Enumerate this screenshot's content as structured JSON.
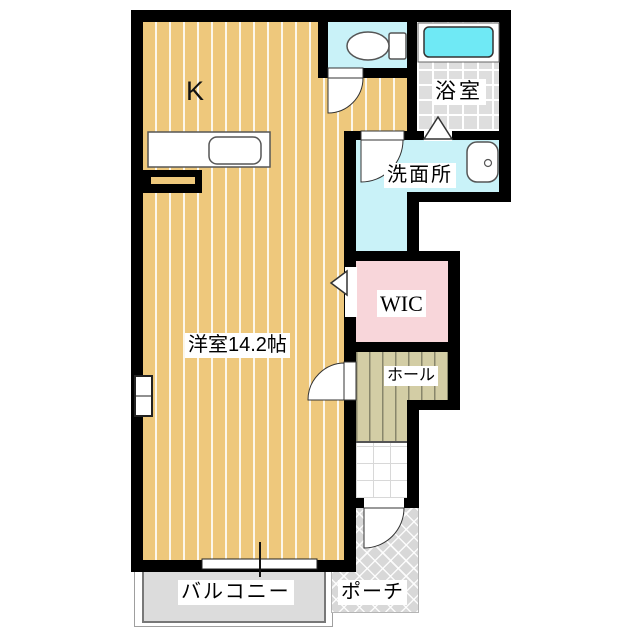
{
  "labels": {
    "kitchen": "K",
    "living_room": "洋室14.2帖",
    "bathroom": "浴室",
    "washroom": "洗面所",
    "wic": "WIC",
    "hall": "ホール",
    "balcony": "バルコニー",
    "porch": "ポーチ"
  },
  "colors": {
    "wall": "#000000",
    "wood_floor": "#eec87c",
    "wood_stripe": "#f7efd9",
    "wet_room_floor": "#c9f2f8",
    "bathtub": "#6fe9f5",
    "bath_tile": "#dedede",
    "wic_floor": "#f8d6da",
    "hall_floor": "#d3cda5",
    "balcony_floor": "#dcdcdc",
    "porch_floor": "#d8d8d8"
  },
  "fixtures": [
    "kitchen-counter",
    "kitchen-sink",
    "toilet",
    "bathtub",
    "washbasin",
    "swing-door",
    "folding-door",
    "window",
    "sliding-window"
  ]
}
